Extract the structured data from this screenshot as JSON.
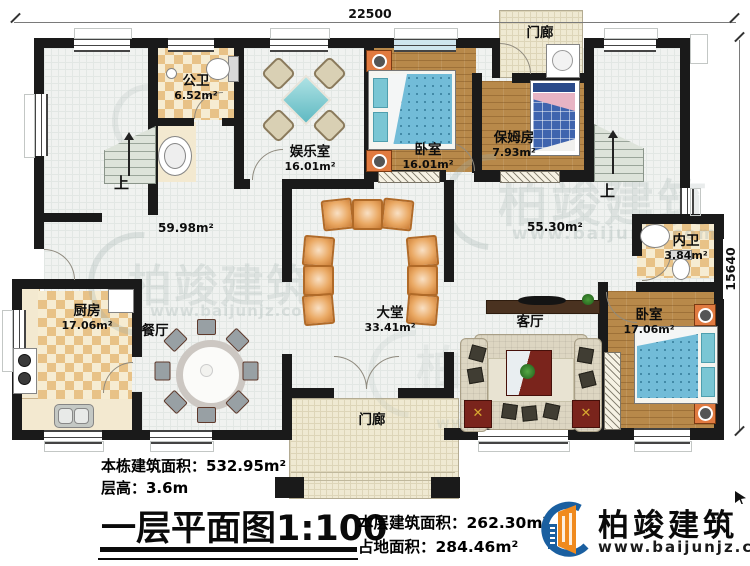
{
  "dims": {
    "top": "22500",
    "right": "15640"
  },
  "stairs": {
    "up": "上"
  },
  "rooms": {
    "gongwei": {
      "name": "公卫",
      "area": "6.52m²"
    },
    "yuleshi": {
      "name": "娱乐室",
      "area": "16.01m²"
    },
    "woshi1": {
      "name": "卧室",
      "area": "16.01m²"
    },
    "menlang_top": {
      "name": "门廊"
    },
    "baomufang": {
      "name": "保姆房",
      "area": "7.93m²"
    },
    "neiwei": {
      "name": "内卫",
      "area": "3.84m²"
    },
    "hall_left": {
      "area": "59.98m²"
    },
    "hall_right": {
      "area": "55.30m²"
    },
    "chufang": {
      "name": "厨房",
      "area": "17.06m²"
    },
    "canting": {
      "name": "餐厅"
    },
    "datang": {
      "name": "大堂",
      "area": "33.41m²"
    },
    "keting": {
      "name": "客厅"
    },
    "woshi2": {
      "name": "卧室",
      "area": "17.06m²"
    },
    "menlang_bottom": {
      "name": "门廊"
    }
  },
  "annotations": {
    "building_area": "本栋建筑面积：532.95m²",
    "floor_height": "层高：3.6m",
    "floor_area": "本层建筑面积：262.30m²",
    "footprint_area": "占地面积：284.46m²"
  },
  "title": {
    "name": "一层平面图",
    "scale": "1:100"
  },
  "brand": {
    "name": "柏竣建筑",
    "url": "www.baijunjz.com"
  },
  "watermark": {
    "text": "柏竣建筑",
    "url": "www.baijunjz.com"
  },
  "colors": {
    "wall": "#1a1a1a",
    "wood_floor": "#b8894a",
    "checker_tile": "#e8c287",
    "bed_blue": "#72bcd8",
    "seat_orange": "#e09a54",
    "brand_blue": "#1a5fa0",
    "brand_orange": "#f08a1e"
  }
}
